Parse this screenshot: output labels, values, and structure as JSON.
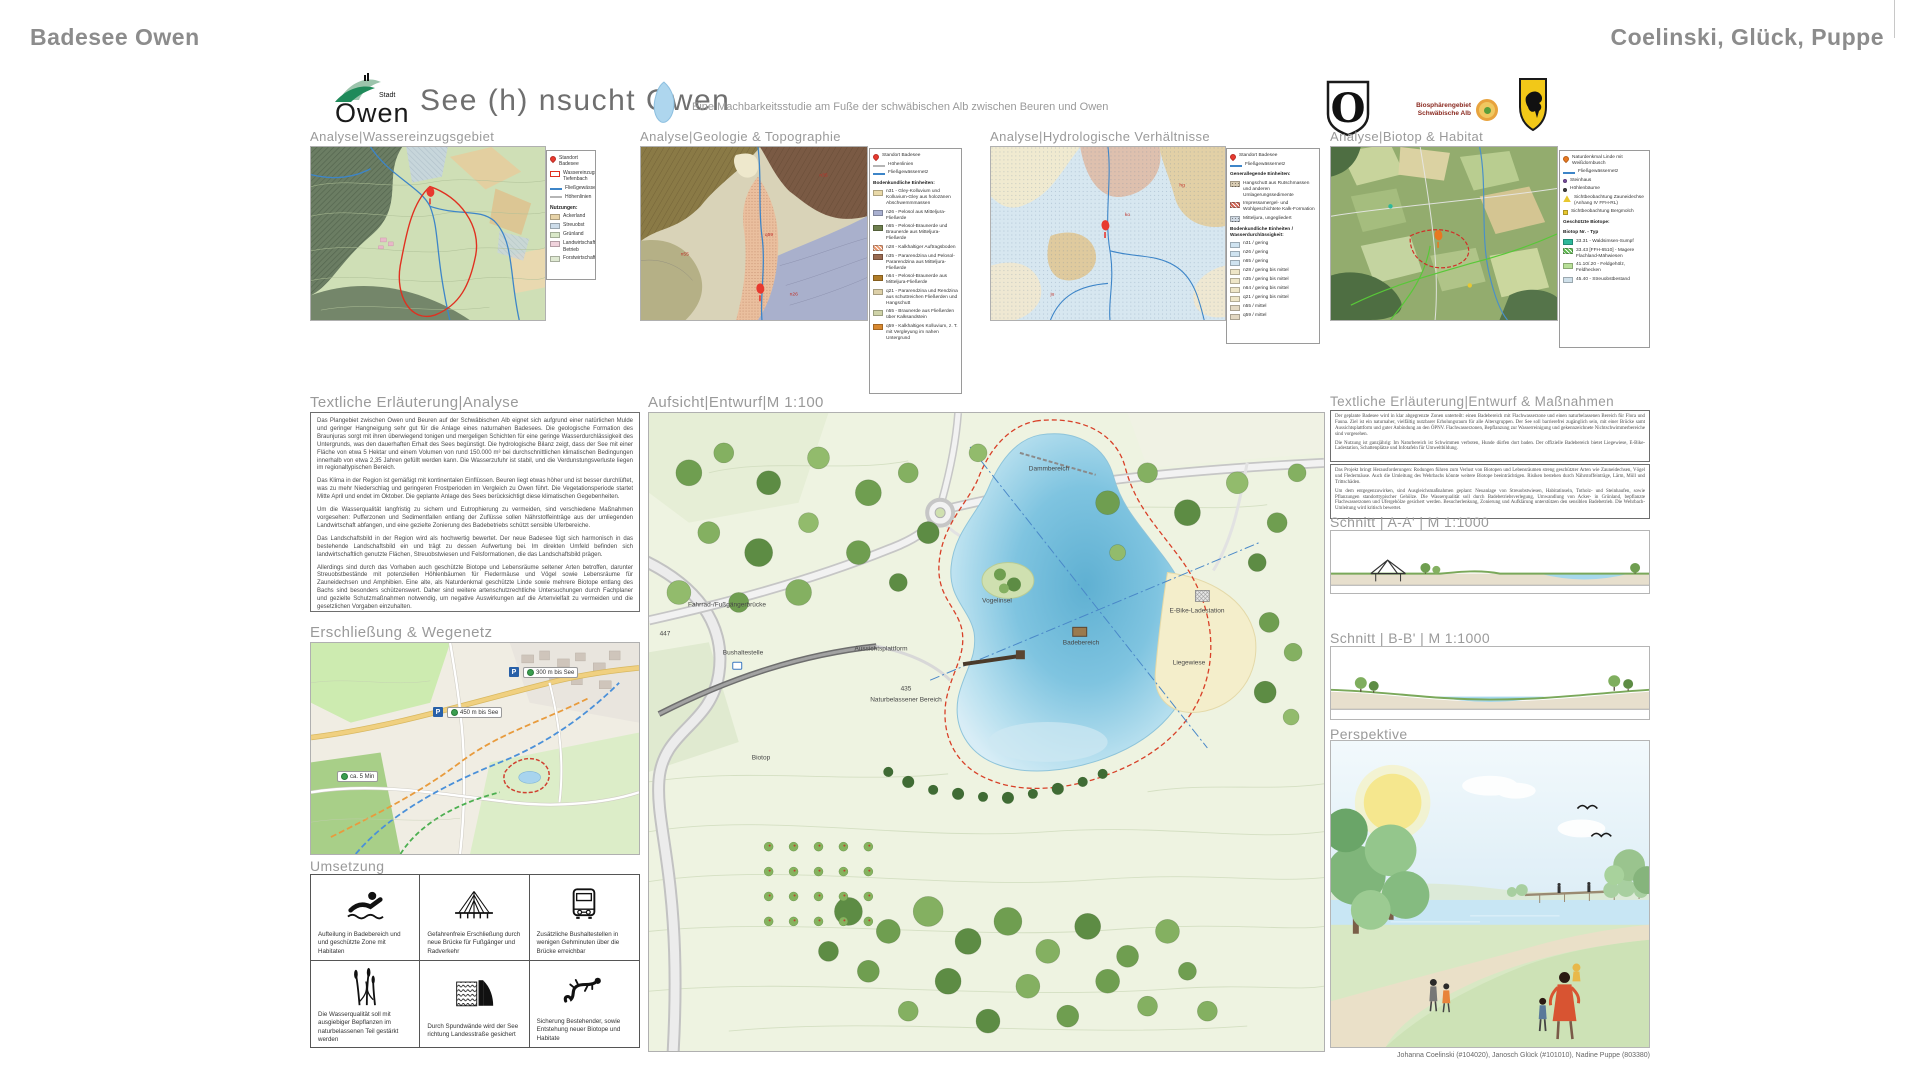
{
  "topbar": {
    "left": "Badesee Owen",
    "right": "Coelinski, Glück, Puppe"
  },
  "header": {
    "stadt": "Stadt",
    "owen": "Owen",
    "title": "See (h) nsucht Owen",
    "subtitle": "Eine Machbarkeitsstudie am Fuße der schwäbischen Alb zwischen Beuren und Owen",
    "biosphere1": "Biosphärengebiet",
    "biosphere2": "Schwäbische Alb",
    "shield_letter": "O"
  },
  "colors": {
    "accent_red": "#d84028",
    "water_blue": "#7fc4e0",
    "stream_blue": "#3d85c8",
    "logo_green": "#1f8a5a"
  },
  "analysis": {
    "p1": {
      "heading": "Analyse|Wassereinzugsgebiet",
      "legend": [
        {
          "type": "pin",
          "color": "#e8392f",
          "label": "Standort Badesee"
        },
        {
          "type": "outline",
          "color": "#e8392f",
          "label": "Wassereinzugsgebiet Tiefenbach"
        },
        {
          "type": "line",
          "color": "#3d85c8",
          "label": "Fließgewässer"
        },
        {
          "type": "line",
          "color": "#b5b5b5",
          "label": "Höhenlinien"
        },
        {
          "type": "header",
          "label": "Nutzungen:"
        },
        {
          "type": "box",
          "color": "#e7d3a8",
          "label": "Ackerland"
        },
        {
          "type": "box",
          "color": "#ccdcea",
          "label": "Streuobst"
        },
        {
          "type": "box",
          "color": "#d9e8c8",
          "label": "Grünland"
        },
        {
          "type": "box",
          "color": "#f0d2dc",
          "label": "Landwirtschaftlicher Betrieb"
        },
        {
          "type": "box",
          "color": "#dfe9d2",
          "label": "Forstwirtschaft"
        }
      ]
    },
    "p2": {
      "heading": "Analyse|Geologie & Topographie",
      "legend": [
        {
          "type": "pin",
          "color": "#e8392f",
          "label": "Standort Badesee"
        },
        {
          "type": "line",
          "color": "#b5b5b5",
          "label": "Höhenlinien"
        },
        {
          "type": "line",
          "color": "#3d85c8",
          "label": "Fließgewässernetz"
        },
        {
          "type": "header",
          "label": "Bodenkundliche Einheiten:"
        },
        {
          "type": "box",
          "color": "#e9d9a8",
          "label": "n31 - Gley-Kolluvium und Kolluvium-Gley aus holozänen Abschwemmmassen"
        },
        {
          "type": "box",
          "color": "#a9b0d0",
          "label": "n26 - Pelosol aus Mitteljura-Fließerde"
        },
        {
          "type": "box",
          "color": "#6e7f4e",
          "label": "n65 - Pelosol-Braunerde und Braunerde aus Mitteljura-Fließerde"
        },
        {
          "type": "hatch",
          "color": "#e8956a",
          "label": "n28 - Kalkhaltiger Auftragsboden"
        },
        {
          "type": "box",
          "color": "#9a6a50",
          "label": "n35 - Pararendzina und Pelosol-Pararendzina aus Mitteljura-Fließerde"
        },
        {
          "type": "box",
          "color": "#b07c28",
          "label": "n64 - Pelosol-Braunerde aus Mitteljura-Fließerde"
        },
        {
          "type": "box",
          "color": "#ddd0a8",
          "label": "q21 - Pararendzina und Rendzina aus schuttreichen Fließerden und Hangschutt"
        },
        {
          "type": "box",
          "color": "#cfd3a8",
          "label": "n55 - Braunerde aus Fließerden über Kalksandstein"
        },
        {
          "type": "box",
          "color": "#d8882f",
          "label": "q59 - Kalkhaltiges Kolluvium, z. T. mit Vergleyung im nahen Untergrund"
        }
      ]
    },
    "p3": {
      "heading": "Analyse|Hydrologische Verhältnisse",
      "legend": [
        {
          "type": "pin",
          "color": "#e8392f",
          "label": "Standort Badesee"
        },
        {
          "type": "line",
          "color": "#3d85c8",
          "label": "Fließgewässernetz"
        },
        {
          "type": "header",
          "label": "Generallegende Einheiten:"
        },
        {
          "type": "hatchdot",
          "color": "#d8cbb2",
          "label": "Hangschutt aus Rutschmassen und anderen Umlagerungssedimente"
        },
        {
          "type": "hatch",
          "color": "#d06050",
          "label": "Impressamergel- und Wohlgeschichtete Kalk-Formation"
        },
        {
          "type": "hatchdot",
          "color": "#cfd8e2",
          "label": "Mitteljura, ungegliedert"
        },
        {
          "type": "header",
          "label": "Bodenkundliche Einheiten / Wasserdurchlässigkeit:"
        },
        {
          "type": "box",
          "color": "#cfe3f0",
          "label": "n31 / gering"
        },
        {
          "type": "box",
          "color": "#cfe3f0",
          "label": "n26 / gering"
        },
        {
          "type": "box",
          "color": "#cfe3f0",
          "label": "n65 / gering"
        },
        {
          "type": "box",
          "color": "#efe6c8",
          "label": "n28 / gering bis mittel"
        },
        {
          "type": "box",
          "color": "#efe6c8",
          "label": "n35 / gering bis mittel"
        },
        {
          "type": "box",
          "color": "#efe6c8",
          "label": "n64 / gering bis mittel"
        },
        {
          "type": "box",
          "color": "#efe6c8",
          "label": "q21 / gering bis mittel"
        },
        {
          "type": "box",
          "color": "#e3d8c2",
          "label": "n55 / mittel"
        },
        {
          "type": "box",
          "color": "#e3d8c2",
          "label": "q59 / mittel"
        }
      ]
    },
    "p4": {
      "heading": "Analyse|Biotop & Habitat",
      "legend": [
        {
          "type": "pin",
          "color": "#e87820",
          "label": "Naturdenkmal Linde mit Weißdornbusch"
        },
        {
          "type": "line",
          "color": "#3d85c8",
          "label": "Fließgewässernetz"
        },
        {
          "type": "dot",
          "color": "#7a4fa0",
          "label": "Steinhaus"
        },
        {
          "type": "dot",
          "color": "#404040",
          "label": "Höhlenbäume"
        },
        {
          "type": "tri",
          "color": "#e8c830",
          "label": "Sichtbeobachtung Zauneidechse (Anhang IV FFH-RL)"
        },
        {
          "type": "sq",
          "color": "#e8c830",
          "label": "Sichtbeobachtung Bergmolch"
        },
        {
          "type": "header",
          "label": "Geschützte Biotope:"
        },
        {
          "type": "header",
          "label": "Biotop Nr. - Typ"
        },
        {
          "type": "box",
          "color": "#2eb89a",
          "label": "33.31 - Waldsimsen-Sumpf"
        },
        {
          "type": "hatch",
          "color": "#58b848",
          "label": "33.43 [FFH-6510] - Magere Flachland-Mähwiesen"
        },
        {
          "type": "box",
          "color": "#b8e098",
          "label": "41.10/.20 - Feldgehölz, Feldhecken"
        },
        {
          "type": "box",
          "color": "#cfe0ea",
          "label": "45.40 - Streuobstbestand"
        }
      ]
    }
  },
  "analyse_text": {
    "heading": "Textliche Erläuterung|Analyse",
    "paragraphs": [
      "Das Plangebiet zwischen Owen und Beuren auf der Schwäbischen Alb eignet sich aufgrund einer natürlichen Mulde und geringer Hangneigung sehr gut für die Anlage eines naturnahen Badesees. Die geologische Formation des Braunjuras sorgt mit ihren überwiegend tonigen und mergeligen Schichten für eine geringe Wasserdurchlässigkeit des Untergrunds, was den dauerhaften Erhalt des Sees begünstigt. Die hydrologische Bilanz zeigt, dass der See mit einer Fläche von etwa 5 Hektar und einem Volumen von rund 150.000 m³ bei durchschnittlichen klimatischen Bedingungen innerhalb von etwa 2,35 Jahren gefüllt werden kann. Die Wasserzufuhr ist stabil, und die Verdunstungsverluste liegen im regionaltypischen Bereich.",
      "Das Klima in der Region ist gemäßigt mit kontinentalen Einflüssen. Beuren liegt etwas höher und ist besser durchlüftet, was zu mehr Niederschlag und geringeren Frostperioden im Vergleich zu Owen führt. Die Vegetationsperiode startet Mitte April und endet im Oktober. Die geplante Anlage des Sees berücksichtigt diese klimatischen Gegebenheiten.",
      "Um die Wasserqualität langfristig zu sichern und Eutrophierung zu vermeiden, sind verschiedene Maßnahmen vorgesehen: Pufferzonen und Sedimentfallen entlang der Zuflüsse sollen Nährstoffeinträge aus der umliegenden Landwirtschaft abfangen, und eine gezielte Zonierung des Badebetriebs schützt sensible Uferbereiche.",
      "Das Landschaftsbild in der Region wird als hochwertig bewertet. Der neue Badesee fügt sich harmonisch in das bestehende Landschaftsbild ein und trägt zu dessen Aufwertung bei. Im direkten Umfeld befinden sich landwirtschaftlich genutzte Flächen, Streuobstwiesen und Felsformationen, die das Landschaftsbild prägen.",
      "Allerdings sind durch das Vorhaben auch geschützte Biotope und Lebensräume seltener Arten betroffen, darunter Streuobstbestände mit potenziellen Höhlenbäumen für Fledermäuse und Vögel sowie Lebensräume für Zauneidechsen und Amphibien. Eine alte, als Naturdenkmal geschützte Linde sowie mehrere Biotope entlang des Bachs sind besonders schützenswert. Daher sind weitere artenschutzrechtliche Untersuchungen durch Fachplaner und gezielte Schutzmaßnahmen notwendig, um negative Auswirkungen auf die Artenvielfalt zu vermeiden und die gesetzlichen Vorgaben einzuhalten."
    ]
  },
  "erschliessung": {
    "heading": "Erschließung & Wegenetz",
    "parking_label": "P",
    "chips": [
      {
        "label": "300 m bis See"
      },
      {
        "label": "450 m bis See"
      },
      {
        "label": "ca. 5 Min"
      }
    ]
  },
  "umsetzung": {
    "heading": "Umsetzung",
    "items": [
      {
        "icon": "swimmer-icon",
        "caption": "Aufteilung in Badebereich und und geschützte Zone mit Habitaten"
      },
      {
        "icon": "bridge-icon",
        "caption": "Gefahrenfreie Erschließung durch neue Brücke für Fußgänger und Radverkehr"
      },
      {
        "icon": "bus-icon",
        "caption": "Zusätzliche Bushaltestellen in wenigen Gehminuten über die Brücke erreichbar"
      },
      {
        "icon": "reeds-icon",
        "caption": "Die Wasserqualität soll mit ausgiebiger Bepflanzen im naturbelassenen Teil gestärkt werden"
      },
      {
        "icon": "dam-icon",
        "caption": "Durch Spundwände wird der See richtung Landesstraße gesichert"
      },
      {
        "icon": "salamander-icon",
        "caption": "Sicherung Bestehender, sowie Entstehung neuer Biotope und Habitate"
      }
    ]
  },
  "plan": {
    "heading": "Aufsicht|Entwurf|M 1:100",
    "labels": {
      "dammbereich": "Dammbereich",
      "vogelinsel": "Vogelinsel",
      "badebereich": "Badebereich",
      "ebike": "E-Bike-Ladestation",
      "liegewiese": "Liegewiese",
      "aussichtsplattform": "Aussichtsplattform",
      "bruecke": "Fahrrad-/Fußgängerbrücke",
      "bushaltestelle": "Bushaltestelle",
      "strasse": "447",
      "hoehe": "435",
      "naturbereich": "Naturbelassener Bereich",
      "biotop": "Biotop"
    }
  },
  "entwurf_text": {
    "heading": "Textliche Erläuterung|Entwurf & Maßnahmen",
    "box1": [
      "Der geplante Badesee wird in klar abgegrenzte Zonen unterteilt: einen Badebereich mit Flachwasserzone und einen naturbelassenen Bereich für Flora und Fauna. Ziel ist ein naturnaher, vielfältig nutzbarer Erholungsraum für alle Altersgruppen. Der See soll barrierefrei zugänglich sein, mit einer Brücke samt Aussichtsplattform und guter Anbindung an den ÖPNV. Flachwasserzonen, Bepflanzung zur Wasserreinigung und gekennzeichnete Nichtschwimmerbereiche sind vorgesehen.",
      "Die Nutzung ist ganzjährig: Im Naturbereich ist Schwimmen verboten, Hunde dürfen dort baden. Der offizielle Badebereich bietet Liegewiese, E-Bike-Ladestation, Schattenplätze und Infotafeln für Umweltbildung."
    ],
    "box2": [
      "Das Projekt bringt Herausforderungen: Rodungen führen zum Verlust von Biotopen und Lebensräumen streng geschützter Arten wie Zauneidechsen, Vögel und Fledermäuse. Auch die Umleitung des Wehrbachs könnte weitere Biotope beeinträchtigen. Risiken bestehen durch Nährstoffeinträge, Lärm, Müll und Trittschäden.",
      "Um dem entgegenzuwirken, sind Ausgleichsmaßnahmen geplant: Neuanlage von Streuobstwiesen, Habitatinseln, Totholz- und Steinhaufen, sowie Pflanzungen standorttypischer Gehölze. Die Wasserqualität soll durch Badebetriebsverlegung, Umwandlung von Acker- in Grünland, bepflanzte Flachwasserzonen und Ufergehölze gesichert werden. Besucherlenkung, Zonierung und Aufklärung unterstützen den sensiblen Badebetrieb. Die Wehrbach-Umleitung wird kritisch bewertet."
    ]
  },
  "schnitt_a": {
    "heading": "Schnitt |  A-A' |  M 1:1000"
  },
  "schnitt_b": {
    "heading": "Schnitt |  B-B' |  M 1:1000"
  },
  "perspektive": {
    "heading": "Perspektive"
  },
  "credits": "Johanna Coelinski (#104020), Janosch Glück (#101010), Nadine Puppe (803380)"
}
